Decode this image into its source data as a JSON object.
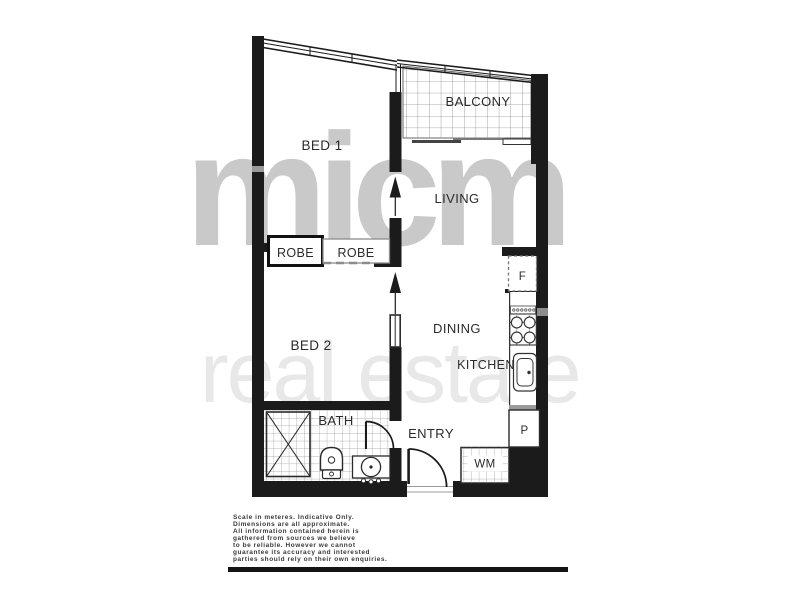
{
  "watermark": {
    "line1": "micm",
    "line2": "real estate"
  },
  "rooms": {
    "bed1": "BED 1",
    "bed2": "BED 2",
    "living": "LIVING",
    "dining": "DINING",
    "kitchen": "KITCHEN",
    "balcony": "BALCONY",
    "bath": "BATH",
    "entry": "ENTRY",
    "robe1": "ROBE",
    "robe2": "ROBE",
    "wm": "WM",
    "pantry": "P",
    "fridge": "F"
  },
  "disclaimer": {
    "lines": [
      "Scale in meteres. Indicative Only.",
      "Dimensions are all approximate.",
      "All information contained herein is",
      "gathered from sources we believe",
      "to be reliable. However we cannot",
      "guarantee its accuracy and interested",
      "parties should rely on their own enquiries."
    ]
  },
  "colors": {
    "wall": "#1b1b1b",
    "watermark_brand": "#c9c9c9",
    "watermark_tagline": "#e8e8e8",
    "tile_line": "#9a9a9a"
  }
}
